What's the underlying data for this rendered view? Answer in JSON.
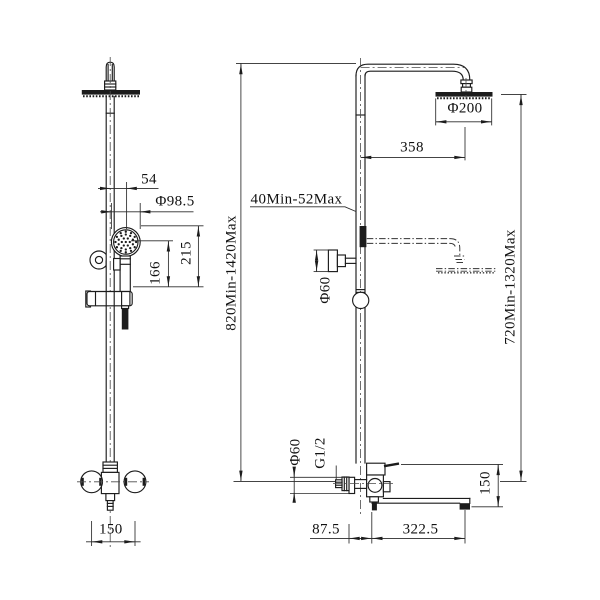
{
  "front_view": {
    "handset_offset": "54",
    "handset_diameter": "Φ98.5",
    "handset_center_to_bracket": "166",
    "handset_top_to_bracket": "215",
    "overall_height_range": "820Min-1420Max",
    "tap_handle_spacing": "150"
  },
  "side_view": {
    "wall_distance_range": "40Min-52Max",
    "arm_reach": "358",
    "head_diameter": "Φ200",
    "bracket_knob_diameter": "Φ60",
    "head_height_range": "720Min-1320Max",
    "escutcheon_diameter": "Φ60",
    "connection_thread": "G1/2",
    "spout_height": "150",
    "wall_to_spout_pivot": "87.5",
    "spout_length": "322.5"
  },
  "colors": {
    "line": "#1c1c1c",
    "dimension": "#2a2a2a",
    "background": "#ffffff",
    "text": "#111111"
  }
}
